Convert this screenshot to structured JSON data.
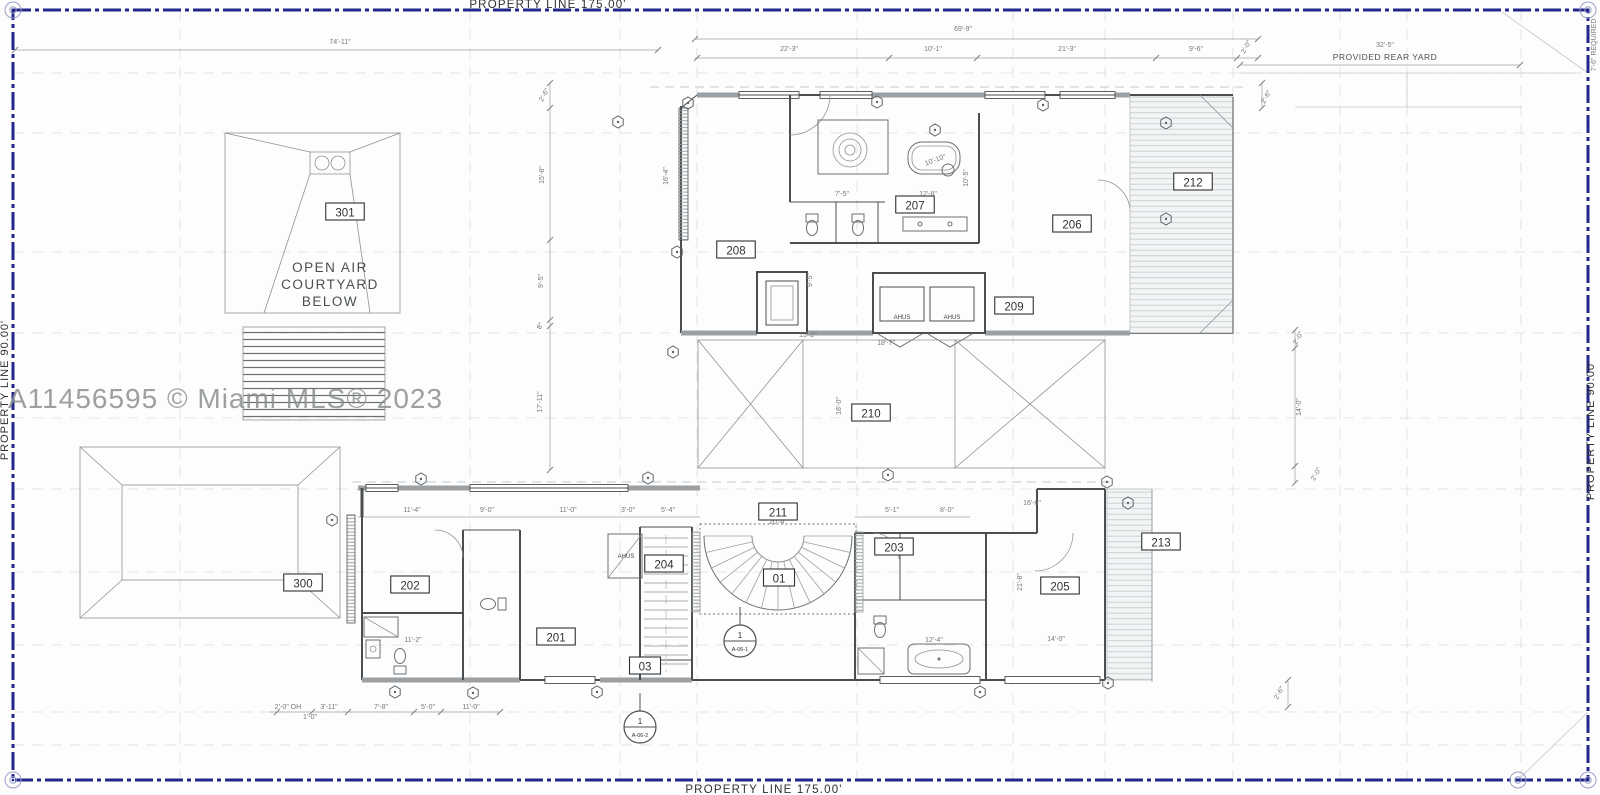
{
  "property": {
    "top": "PROPERTY LINE 175.00'",
    "bottom": "PROPERTY LINE 175.00'",
    "left": "PROPERTY LINE 90.00'",
    "right": "PROPERTY LINE 90.00'",
    "right_top_note": "7'-6\" REQUIRED",
    "rear_yard_label": "PROVIDED REAR YARD"
  },
  "watermark": "A11456595 © Miami MLS® 2023",
  "courtyard": {
    "line1": "OPEN AIR",
    "line2": "COURTYARD",
    "line3": "BELOW"
  },
  "rooms": [
    {
      "id": "301",
      "x": 345,
      "y": 212
    },
    {
      "id": "212",
      "x": 1193,
      "y": 182
    },
    {
      "id": "208",
      "x": 736,
      "y": 250
    },
    {
      "id": "207",
      "x": 915,
      "y": 205
    },
    {
      "id": "206",
      "x": 1072,
      "y": 224
    },
    {
      "id": "209",
      "x": 1014,
      "y": 306
    },
    {
      "id": "210",
      "x": 871,
      "y": 413
    },
    {
      "id": "211",
      "x": 778,
      "y": 512
    },
    {
      "id": "01",
      "x": 779,
      "y": 578
    },
    {
      "id": "204",
      "x": 664,
      "y": 564
    },
    {
      "id": "03",
      "x": 645,
      "y": 666
    },
    {
      "id": "203",
      "x": 894,
      "y": 547
    },
    {
      "id": "205",
      "x": 1060,
      "y": 586
    },
    {
      "id": "213",
      "x": 1161,
      "y": 542
    },
    {
      "id": "300",
      "x": 303,
      "y": 583
    },
    {
      "id": "202",
      "x": 410,
      "y": 585
    },
    {
      "id": "201",
      "x": 556,
      "y": 637
    }
  ],
  "dimensions": [
    {
      "t": "74'-11\"",
      "x": 340,
      "y": 44,
      "r": 0
    },
    {
      "t": "69'-9\"",
      "x": 963,
      "y": 31,
      "r": 0
    },
    {
      "t": "22'-3\"",
      "x": 789,
      "y": 51,
      "r": 0
    },
    {
      "t": "10'-1\"",
      "x": 933,
      "y": 51,
      "r": 0
    },
    {
      "t": "21'-3\"",
      "x": 1067,
      "y": 51,
      "r": 0
    },
    {
      "t": "9'-6\"",
      "x": 1196,
      "y": 51,
      "r": 0
    },
    {
      "t": "2'-0\"",
      "x": 1248,
      "y": 48,
      "r": -60
    },
    {
      "t": "32'-5\"",
      "x": 1385,
      "y": 47,
      "r": 0
    },
    {
      "t": "2'-6\"",
      "x": 546,
      "y": 96,
      "r": -60
    },
    {
      "t": "15'-8\"",
      "x": 544,
      "y": 175,
      "r": -90
    },
    {
      "t": "9'-5\"",
      "x": 543,
      "y": 281,
      "r": -90
    },
    {
      "t": "8\"",
      "x": 542,
      "y": 327,
      "r": -60
    },
    {
      "t": "17'-11\"",
      "x": 542,
      "y": 402,
      "r": -90
    },
    {
      "t": "16'-4\"",
      "x": 668,
      "y": 176,
      "r": -90
    },
    {
      "t": "9'-5\"",
      "x": 812,
      "y": 280,
      "r": -90
    },
    {
      "t": "2'-6\"",
      "x": 1268,
      "y": 98,
      "r": -60
    },
    {
      "t": "2'-0\"",
      "x": 1300,
      "y": 339,
      "r": -60
    },
    {
      "t": "14'-0\"",
      "x": 1301,
      "y": 407,
      "r": -90
    },
    {
      "t": "2'-0\"",
      "x": 1318,
      "y": 475,
      "r": -60
    },
    {
      "t": "2'-6\"",
      "x": 1281,
      "y": 694,
      "r": -60
    },
    {
      "t": "2'-0\" OH",
      "x": 288,
      "y": 709,
      "r": 0
    },
    {
      "t": "3'-11\"",
      "x": 329,
      "y": 709,
      "r": 0
    },
    {
      "t": "7'-8\"",
      "x": 381,
      "y": 709,
      "r": 0
    },
    {
      "t": "5'-0\"",
      "x": 428,
      "y": 709,
      "r": 0
    },
    {
      "t": "11'-0\"",
      "x": 471,
      "y": 709,
      "r": 0
    },
    {
      "t": "1'-0\"",
      "x": 310,
      "y": 719,
      "r": 0
    },
    {
      "t": "11'-4\"",
      "x": 412,
      "y": 512,
      "r": 0
    },
    {
      "t": "9'-0\"",
      "x": 487,
      "y": 512,
      "r": 0
    },
    {
      "t": "11'-0\"",
      "x": 568,
      "y": 512,
      "r": 0
    },
    {
      "t": "3'-0\"",
      "x": 628,
      "y": 512,
      "r": 0
    },
    {
      "t": "5'-4\"",
      "x": 668,
      "y": 512,
      "r": 0
    },
    {
      "t": "5'-1\"",
      "x": 892,
      "y": 512,
      "r": 0
    },
    {
      "t": "8'-0\"",
      "x": 947,
      "y": 512,
      "r": 0
    },
    {
      "t": "20'-4\"",
      "x": 778,
      "y": 524,
      "r": 0
    },
    {
      "t": "13'-2\"",
      "x": 808,
      "y": 337,
      "r": 0
    },
    {
      "t": "18'-7\"",
      "x": 886,
      "y": 345,
      "r": 0
    },
    {
      "t": "18'-0\"",
      "x": 841,
      "y": 406,
      "r": -90
    },
    {
      "t": "7'-5\"",
      "x": 842,
      "y": 196,
      "r": 0
    },
    {
      "t": "12'-8\"",
      "x": 928,
      "y": 196,
      "r": 0
    },
    {
      "t": "10'-10\"",
      "x": 936,
      "y": 162,
      "r": -20
    },
    {
      "t": "10'-5\"",
      "x": 968,
      "y": 178,
      "r": -90
    },
    {
      "t": "16'-0\"",
      "x": 1032,
      "y": 505,
      "r": 0
    },
    {
      "t": "14'-0\"",
      "x": 1056,
      "y": 641,
      "r": 0
    },
    {
      "t": "21'-8\"",
      "x": 1022,
      "y": 582,
      "r": -90
    },
    {
      "t": "12'-4\"",
      "x": 934,
      "y": 642,
      "r": 0
    },
    {
      "t": "11'-2\"",
      "x": 413,
      "y": 642,
      "r": 0
    }
  ],
  "equipment_labels": [
    {
      "t": "AHUS",
      "x": 902,
      "y": 319
    },
    {
      "t": "AHUS",
      "x": 952,
      "y": 319
    },
    {
      "t": "AHUS",
      "x": 626,
      "y": 558
    }
  ],
  "section_markers": [
    {
      "num": "1",
      "sheet": "A-06-1",
      "x": 740,
      "y": 641
    },
    {
      "num": "1",
      "sheet": "A-06-2",
      "x": 640,
      "y": 727
    }
  ],
  "hex_markers": [
    [
      688,
      103
    ],
    [
      877,
      102
    ],
    [
      1043,
      105
    ],
    [
      935,
      130
    ],
    [
      1166,
      123
    ],
    [
      1166,
      219
    ],
    [
      677,
      252
    ],
    [
      673,
      352
    ],
    [
      618,
      122
    ],
    [
      421,
      479
    ],
    [
      648,
      478
    ],
    [
      332,
      520
    ],
    [
      888,
      475
    ],
    [
      395,
      692
    ],
    [
      473,
      693
    ],
    [
      597,
      692
    ],
    [
      980,
      692
    ],
    [
      1107,
      482
    ],
    [
      1128,
      503
    ],
    [
      1108,
      683
    ]
  ],
  "colors": {
    "property_line": "#23278c",
    "wall": "#4a4e50",
    "dim_text": "#75797c",
    "label_text": "#2e3133",
    "watermark": "#8c8f91",
    "grid": "#dcdedf",
    "hatch": "#c3c7ca"
  }
}
